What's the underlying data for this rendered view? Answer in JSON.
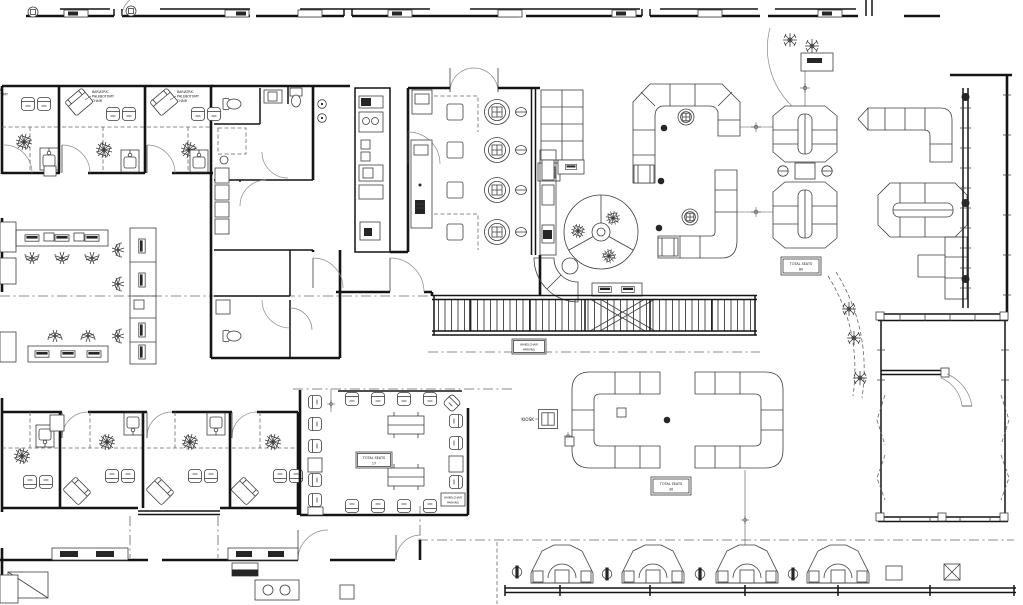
{
  "drawing": {
    "type": "architectural-floor-plan",
    "callout": {
      "line1": "BARIATRIC",
      "line2": "PHLEBOTOMY",
      "line3": "CHAIR"
    },
    "seat_tags": {
      "label": "TOTAL SEATS",
      "right_lounge": "60",
      "small_waiting_room": "17",
      "center_lounge": "30"
    },
    "kiosk_label": "KIOSK",
    "parking_tag": {
      "line1": "WHEELCHAIR",
      "line2": "PARKING"
    },
    "colors": {
      "background": "#ffffff",
      "walls": "#141414",
      "furniture": "#3d3d3d",
      "light_lines": "#8a8a8a"
    },
    "symbols": [
      "phlebotomy-draw-chair",
      "guest-chair",
      "recliner-chair",
      "sink-cabinet",
      "toilet",
      "lavatory",
      "round-draw-station",
      "structural-column",
      "waste-bin",
      "planter",
      "booth-pod",
      "check-in-kiosk",
      "monitor-workstation",
      "banquette-island",
      "lounge-sofa-run",
      "section-marker",
      "door-swing",
      "walkway-hatch"
    ]
  }
}
